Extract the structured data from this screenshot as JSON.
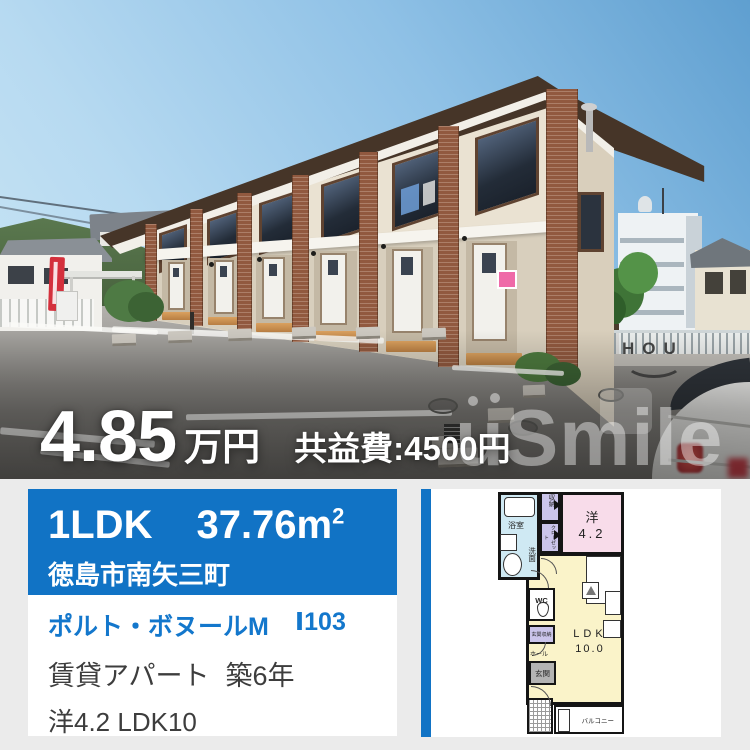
{
  "photo": {
    "price": {
      "value": "4.85",
      "unit": "万円",
      "fee": "共益費:4500円"
    },
    "watermark": {
      "top": "HOU",
      "main": "uSmile"
    }
  },
  "card": {
    "header": {
      "layout": "1LDK",
      "area": "37.76m",
      "area_sup": "2",
      "location": "徳島市南矢三町",
      "bg": "#1173c5"
    },
    "body": {
      "name": "ポルト・ボヌールM",
      "unit": "Ⅰ103",
      "category": "賃貸アパート",
      "age": "築6年",
      "rooms": "洋4.2 LDK10",
      "name_color": "#1377cc"
    }
  },
  "floorplan": {
    "labels": {
      "bath": "浴室",
      "wash": "洗面",
      "storage": "収納",
      "closet": "クローゼット",
      "western": "洋",
      "western_size": "4.2",
      "wc": "WC",
      "entrance_storage": "玄関収納",
      "hall": "ホール",
      "entrance": "玄関",
      "ldk": "LDK",
      "ldk_size": "10.0",
      "balcony": "バルコニー"
    },
    "colors": {
      "bath": "#cfe9f3",
      "storage": "#cbc5eb",
      "western": "#f8dcea",
      "ldk": "#faf3c9",
      "entrance": "#b3b3b3"
    }
  }
}
